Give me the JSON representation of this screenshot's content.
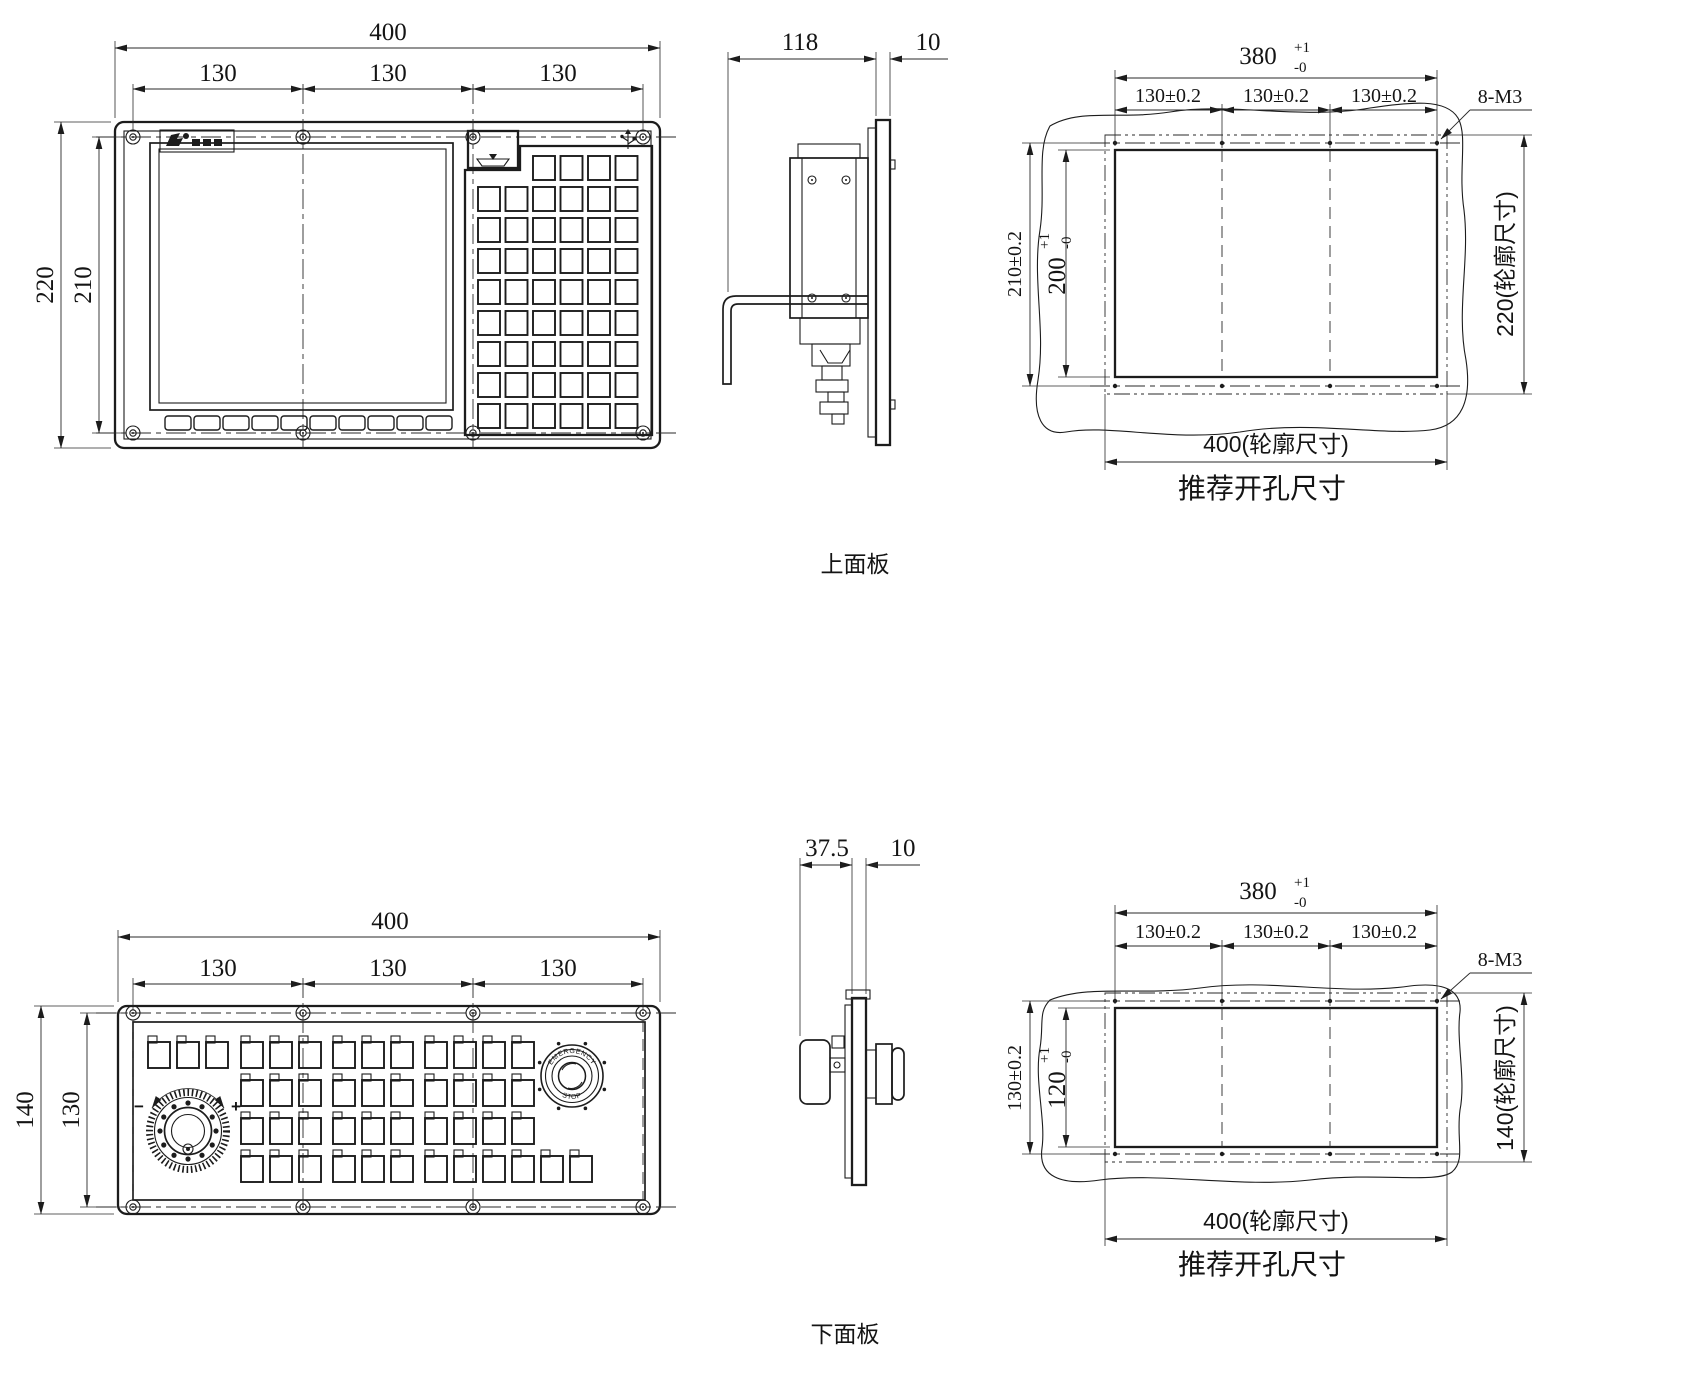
{
  "drawing": {
    "upper": {
      "label": "上面板",
      "front": {
        "dim_width": "400",
        "dim_pitch": [
          "130",
          "130",
          "130"
        ],
        "dim_height": "220",
        "dim_hole_rows": "210"
      },
      "side": {
        "dim_depth": "118",
        "dim_thickness": "10"
      },
      "cutout": {
        "dim_width_base": "380",
        "dim_width_tol_plus": "+1",
        "dim_width_tol_minus": "-0",
        "dim_pitch": [
          "130±0.2",
          "130±0.2",
          "130±0.2"
        ],
        "thread_callout": "8-M3",
        "dim_hole_rows": "210±0.2",
        "dim_height_base": "200",
        "dim_height_tol_plus": "+1",
        "dim_height_tol_minus": "-0",
        "outline_height_label": "220(轮廓尺寸)",
        "outline_width_label": "400(轮廓尺寸)",
        "caption": "推荐开孔尺寸"
      }
    },
    "lower": {
      "label": "下面板",
      "front": {
        "dim_width": "400",
        "dim_pitch": [
          "130",
          "130",
          "130"
        ],
        "dim_height": "140",
        "dim_hole_rows": "130",
        "handwheel_minus": "−",
        "handwheel_plus": "+",
        "estop_text_top": "EMERGENCY",
        "estop_text_bottom": "STOP"
      },
      "side": {
        "dim_depth": "37.5",
        "dim_thickness": "10"
      },
      "cutout": {
        "dim_width_base": "380",
        "dim_width_tol_plus": "+1",
        "dim_width_tol_minus": "-0",
        "dim_pitch": [
          "130±0.2",
          "130±0.2",
          "130±0.2"
        ],
        "thread_callout": "8-M3",
        "dim_hole_rows": "130±0.2",
        "dim_height_base": "120",
        "dim_height_tol_plus": "+1",
        "dim_height_tol_minus": "-0",
        "outline_height_label": "140(轮廓尺寸)",
        "outline_width_label": "400(轮廓尺寸)",
        "caption": "推荐开孔尺寸"
      }
    }
  }
}
